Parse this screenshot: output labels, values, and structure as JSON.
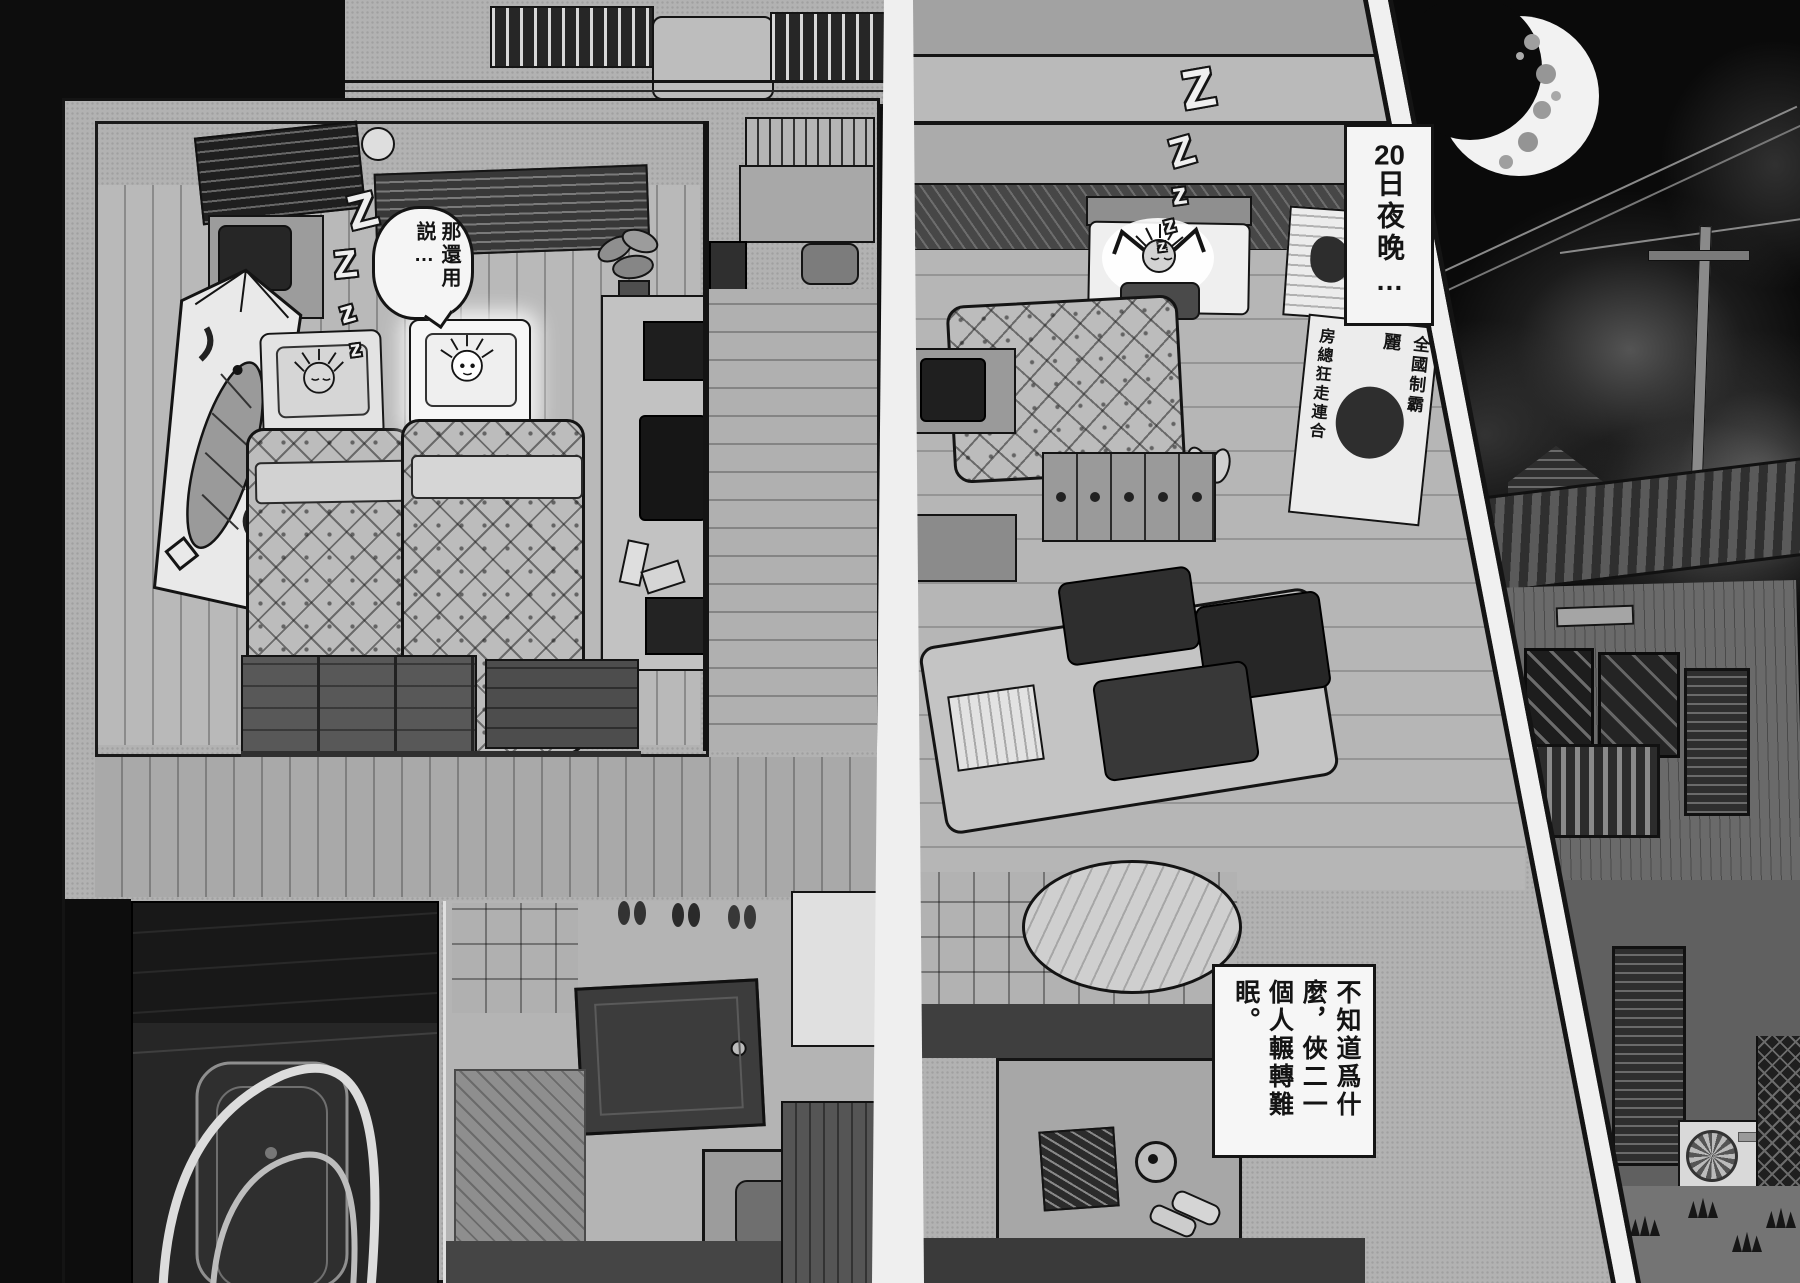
{
  "comic": {
    "left_page": {
      "sleep_zs": [
        "Z",
        "Z",
        "z",
        "z"
      ],
      "speech_bubble": {
        "col_right": "那還用",
        "col_left": "説…"
      }
    },
    "right_page": {
      "sleep_zs": [
        "Z",
        "Z",
        "z",
        "z",
        "z"
      ],
      "flag_poster": {
        "col_right": "全國制霸",
        "col_mid": "麗",
        "col_left": "房總狂走連合"
      },
      "narration": {
        "col1": "不知道爲什",
        "col2": "麼，俠二一",
        "col3": "個人輾轉難",
        "col4": "眠。"
      }
    },
    "night_panel": {
      "caption_number": "20",
      "caption_text": "日夜晚…"
    },
    "colors": {
      "paper": "#b2b2b2",
      "ink": "#141414",
      "night_sky": "#0a0a0a",
      "moon": "#f2f2f2"
    }
  }
}
